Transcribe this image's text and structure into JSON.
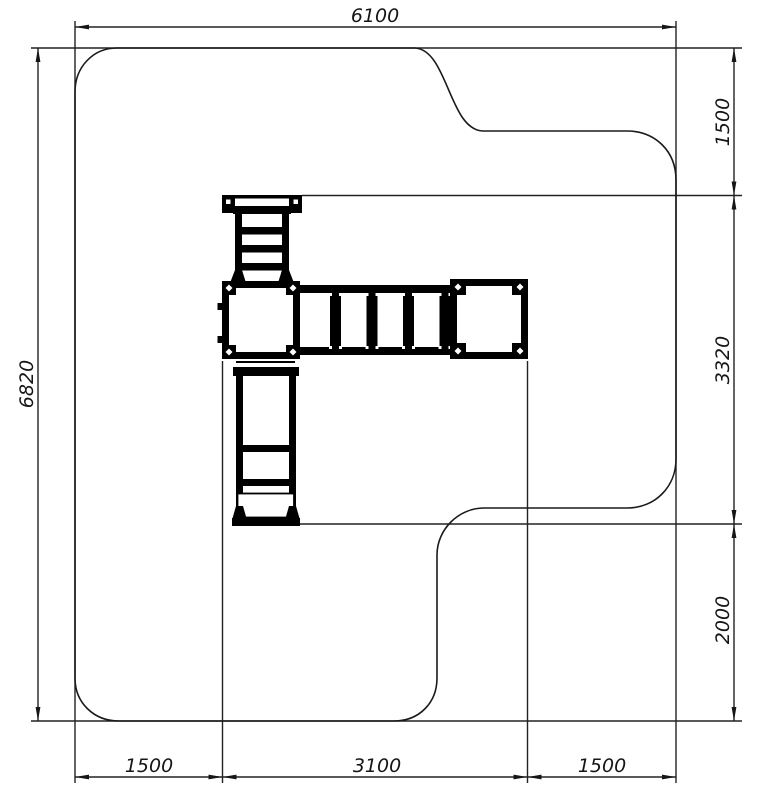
{
  "drawing": {
    "type": "playground-equipment-safety-zone-plan",
    "background_color": "#ffffff",
    "outline_color": "#1a1a1a",
    "equipment_color": "#000000",
    "dimensions": {
      "top_width": "6100",
      "left_height": "6820",
      "right": [
        "1500",
        "3320",
        "2000"
      ],
      "bottom": [
        "1500",
        "3100",
        "1500"
      ]
    }
  }
}
